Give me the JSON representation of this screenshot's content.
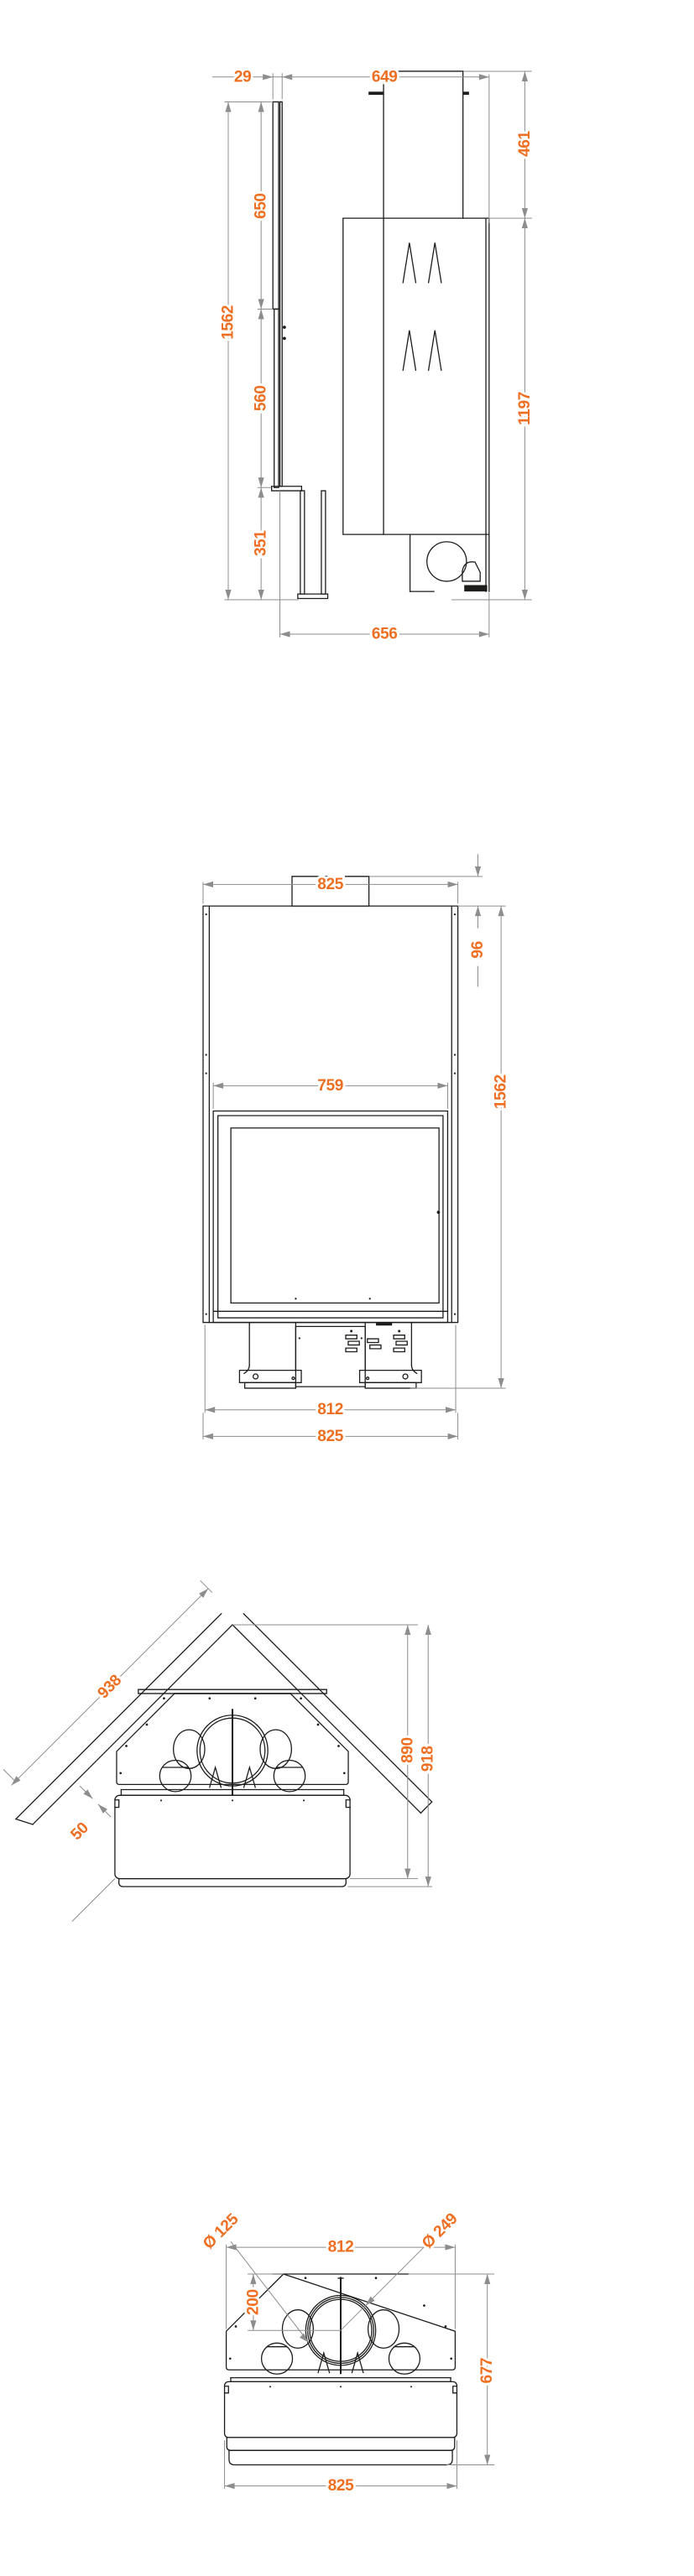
{
  "document": {
    "type": "fireplace technical dimension drawing"
  },
  "colors": {
    "dimension_text": "#ee6f21",
    "dimension_line": "#8d8d8d",
    "drawing_line": "#1d1d1b",
    "background": "#ffffff"
  },
  "views": {
    "side": {
      "panel_thickness": "29",
      "top_depth": "649",
      "collar_height": "461",
      "panel_upper": "650",
      "total_height": "1562",
      "panel_middle": "560",
      "body_height": "1197",
      "panel_lower": "351",
      "base_depth": "656"
    },
    "front": {
      "top_width": "825",
      "collar_height": "96",
      "door_width": "759",
      "total_height": "1562",
      "feet_width": "812",
      "base_width": "825"
    },
    "corner": {
      "wall_length": "938",
      "wall_clearance": "50",
      "depth_body": "890",
      "depth_total": "918"
    },
    "top": {
      "intake_diameter": "Ø 125",
      "back_width": "812",
      "flue_diameter": "Ø 249",
      "flue_offset": "200",
      "depth": "677",
      "base_width": "825"
    }
  }
}
